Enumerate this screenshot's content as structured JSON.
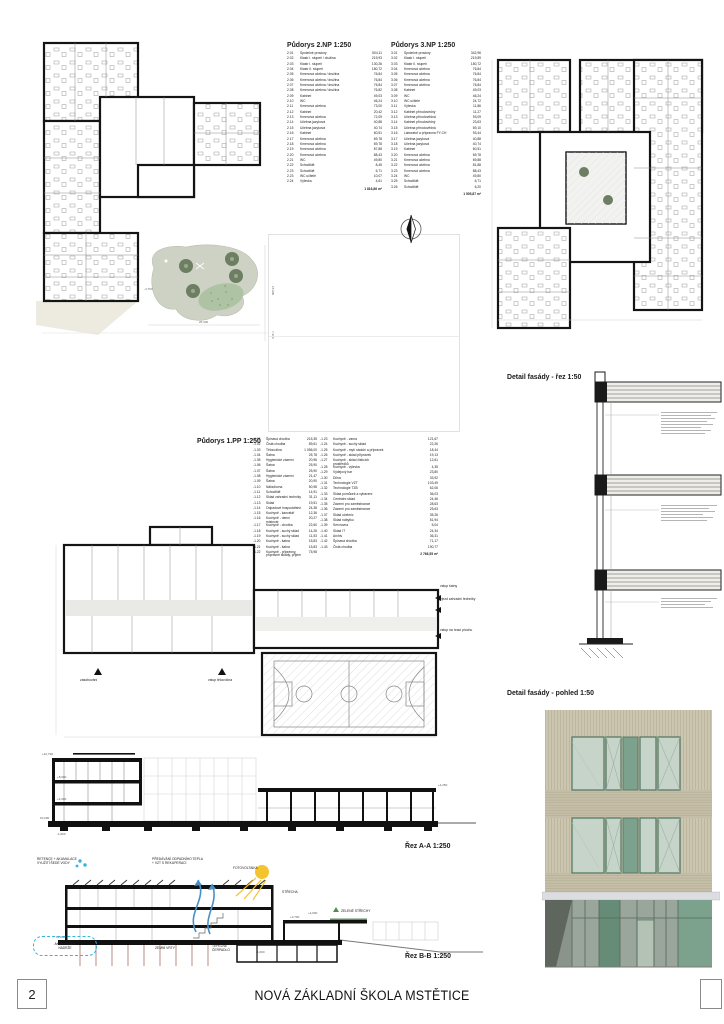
{
  "sheet": {
    "number": "2",
    "title": "NOVÁ ZÁKLADNÍ ŠKOLA MSTĚTICE"
  },
  "legend_np2": {
    "title": "Půdorys 2.NP  1:250",
    "rows": [
      [
        "2.01",
        "Společné prostory",
        "504,11"
      ],
      [
        "2.02",
        "Klastr I. stupeň / družina",
        "219,93"
      ],
      [
        "2.03",
        "Klastr I. stupeň",
        "130,26"
      ],
      [
        "2.04",
        "Klastr II. stupeň",
        "180,72"
      ],
      [
        "2.05",
        "Kmenová učebna / družina",
        "76,84"
      ],
      [
        "2.06",
        "Kmenová učebna / družina",
        "76,84"
      ],
      [
        "2.07",
        "Kmenová učebna / družina",
        "76,84"
      ],
      [
        "2.08",
        "Kmenová učebna / družina",
        "76,82"
      ],
      [
        "2.09",
        "Kabinet",
        "49,03"
      ],
      [
        "2.10",
        "WC",
        "46,24"
      ],
      [
        "2.11",
        "Kmenová učebna",
        "73,00"
      ],
      [
        "2.12",
        "Kabinet",
        "20,42"
      ],
      [
        "2.13",
        "Kmenová učebna",
        "72,09"
      ],
      [
        "2.14",
        "Učebna jazyková",
        "40,88"
      ],
      [
        "2.15",
        "Učebna jazyková",
        "40,74"
      ],
      [
        "2.16",
        "Kabinet",
        "60,51"
      ],
      [
        "2.17",
        "Kmenová učebna",
        "69,78"
      ],
      [
        "2.18",
        "Kmenová učebna",
        "69,78"
      ],
      [
        "2.19",
        "Kmenová učebna",
        "87,88"
      ],
      [
        "2.20",
        "Kmenová učebna",
        "88,43"
      ],
      [
        "2.21",
        "WC",
        "49,80"
      ],
      [
        "2.22",
        "Schodiště",
        "8,45"
      ],
      [
        "2.23",
        "Schodiště",
        "6,71"
      ],
      [
        "2.23",
        "WC učitelé",
        "10,07"
      ],
      [
        "2.24",
        "Výlevka",
        "4,61"
      ]
    ],
    "total": "1 816,86 m²"
  },
  "legend_np3": {
    "title": "Půdorys 3.NP  1:250",
    "rows": [
      [
        "3.01",
        "Společné prostory",
        "342,96"
      ],
      [
        "3.02",
        "Klastr I. stupeň",
        "219,89"
      ],
      [
        "3.03",
        "Klastr II. stupeň",
        "180,72"
      ],
      [
        "3.04",
        "Kmenová učebna",
        "76,84"
      ],
      [
        "3.05",
        "Kmenová učebna",
        "76,84"
      ],
      [
        "3.06",
        "Kmenová učebna",
        "76,84"
      ],
      [
        "3.07",
        "Kmenová učebna",
        "76,84"
      ],
      [
        "3.08",
        "Kabinet",
        "49,03"
      ],
      [
        "3.09",
        "WC",
        "46,24"
      ],
      [
        "3.10",
        "WC učitelé",
        "24,72"
      ],
      [
        "3.11",
        "Výlevka",
        "11,86"
      ],
      [
        "3.12",
        "Kabinet přírodovědný",
        "11,27"
      ],
      [
        "3.13",
        "Učebna přírodovědná",
        "93,09"
      ],
      [
        "3.14",
        "Kabinet přírodovědný",
        "23,63"
      ],
      [
        "3.15",
        "Učebna přírodovědná",
        "69,10"
      ],
      [
        "3.16",
        "Laboratoř a přípravna FY-CH",
        "93,44"
      ],
      [
        "3.17",
        "Učebna jazyková",
        "40,88"
      ],
      [
        "3.18",
        "Učebna jazyková",
        "40,74"
      ],
      [
        "3.19",
        "Kabinet",
        "60,51"
      ],
      [
        "3.20",
        "Kmenová učebna",
        "69,78"
      ],
      [
        "3.21",
        "Kmenová učebna",
        "69,88"
      ],
      [
        "3.22",
        "Kmenová učebna",
        "81,88"
      ],
      [
        "3.23",
        "Kmenová učebna",
        "88,43"
      ],
      [
        "3.24",
        "WC",
        "49,80"
      ],
      [
        "3.25",
        "Schodiště",
        "6,71"
      ],
      [
        "3.26",
        "Schodiště",
        "6,20"
      ]
    ],
    "total": "1 505,87 m²"
  },
  "legend_pp1": {
    "title": "Půdorys 1.PP  1:250",
    "rows_left": [
      [
        "-1.01",
        "Špinavá chodba",
        "215,35"
      ],
      [
        "-1.02",
        "Čistá chodba",
        "89,61"
      ],
      [
        "-1.03",
        "Tělocvična",
        "1 056,00"
      ],
      [
        "-1.04",
        "Šatna",
        "25,78"
      ],
      [
        "-1.05",
        "Hygienické zázemí",
        "20,96"
      ],
      [
        "-1.06",
        "Šatna",
        "25,90"
      ],
      [
        "-1.07",
        "Šatna",
        "25,90"
      ],
      [
        "-1.08",
        "Hygienické zázemí",
        "21,47"
      ],
      [
        "-1.09",
        "Šatna",
        "20,90"
      ],
      [
        "-1.10",
        "Nářaďovna",
        "50,98"
      ],
      [
        "-1.11",
        "Schodiště",
        "14,91"
      ],
      [
        "-1.12",
        "Sklad zahradní techniky",
        "31,11"
      ],
      [
        "-1.13",
        "Sklad",
        "19,51"
      ],
      [
        "-1.14",
        "Odpadové hospodářství",
        "24,38"
      ],
      [
        "-1.15",
        "Kuchyně - kancelář",
        "12,36"
      ],
      [
        "-1.16",
        "Kuchyně - denní místnost",
        "20,27"
      ],
      [
        "-1.17",
        "Kuchyně - chodba",
        "22,60"
      ],
      [
        "-1.18",
        "Kuchyně - suchý sklad",
        "14,26"
      ],
      [
        "-1.19",
        "Kuchyně - suchý sklad",
        "11,53"
      ],
      [
        "-1.20",
        "Kuchyně - šatna",
        "15,83"
      ],
      [
        "-1.21",
        "Kuchyně - šatna",
        "15,83"
      ],
      [
        "-1.22",
        "Kuchyně - přípravny, přípravné sklady, příjem",
        "75,98"
      ]
    ],
    "rows_right": [
      [
        "-1.23",
        "Kuchyně - varna",
        "121,67"
      ],
      [
        "-1.24",
        "Kuchyně - suchý sklad",
        "22,26"
      ],
      [
        "-1.25",
        "Kuchyně - mytí nádobí a přípravek",
        "18,44"
      ],
      [
        "-1.26",
        "Kuchyně - sklad přípravek",
        "19,13"
      ],
      [
        "-1.27",
        "Kuchyně - sklad čisticích prostředků",
        "12,61"
      ],
      [
        "-1.28",
        "Kuchyně - výlevka",
        "4,35"
      ],
      [
        "-1.29",
        "Výdejový bar",
        "23,80"
      ],
      [
        "-1.30",
        "Dílna",
        "33,92"
      ],
      [
        "-1.31",
        "Technologie VZT",
        "103,49"
      ],
      [
        "-1.32",
        "Technologie TZB",
        "62,06"
      ],
      [
        "-1.33",
        "Sklad pomůcek a vybavení",
        "36,03"
      ],
      [
        "-1.34",
        "Centrální sklad",
        "24,46"
      ],
      [
        "-1.35",
        "Zázemí pro zaměstnance",
        "28,63"
      ],
      [
        "-1.36",
        "Zázemí pro zaměstnance",
        "25,63"
      ],
      [
        "-1.37",
        "Sklad učebnic",
        "35,26"
      ],
      [
        "-1.38",
        "Sklad nábytku",
        "51,94"
      ],
      [
        "-1.39",
        "Servrovna",
        "5,04"
      ],
      [
        "-1.40",
        "Sklad IT",
        "24,34"
      ],
      [
        "-1.41",
        "Archiv",
        "36,31"
      ],
      [
        "-1.42",
        "Špinavá chodba",
        "71,17"
      ],
      [
        "-1.43",
        "Čistá chodba",
        "190,77"
      ]
    ],
    "total": "2 766,55 m²"
  },
  "details": {
    "facade_section_title": "Detail fasády - řez 1:50",
    "facade_elevation_title": "Detail fasády - pohled 1:50"
  },
  "sections": {
    "a_label": "Řez A-A 1:250",
    "b_label": "Řez B-B 1:250"
  },
  "plan_pp1_labels": {
    "vstup_satny": "vstup šatny",
    "vjezd": "vjezd zahradní techniky",
    "vstup_hraci": "vstup na hrací plochu",
    "zasobovani": "zásobování",
    "vstup_telocvicna": "vstup tělocvična"
  },
  "eco": {
    "retence": "RETENCE + AKUMULACE\nVYUŽITÍ ŠEDÉ VODY",
    "teplo": "PŘEDÁVÁNÍ ODPADNÍHO TEPLA\n+ VZT S REKUPERACÍ",
    "fotovoltaika": "FOTOVOLTAIKA",
    "strecha": "STŘECHA",
    "zelene": "ZELENÉ STŘECHY",
    "nadrze": "AKUMULAČNÍ\nNÁDRŽE",
    "vrty": "ZEMNÍ VRTY",
    "cerpadlo": "TEPELNÉ\nČERPADLO"
  },
  "plan2_dims": [
    "-4.750",
    "26.300",
    "18.900",
    "7.300"
  ],
  "levels_a": [
    "+12,790",
    "+8,000",
    "+4,000",
    "±0,000",
    "-1,000",
    "+4,250"
  ],
  "levels_b": [
    "±0,000",
    "+4,000",
    "+3,700",
    "-1,000"
  ],
  "colors": {
    "water_accent": "#35b6d9",
    "sun": "#f4c42e",
    "green_roof": "#4f8f4f",
    "tree": "#6e7e62",
    "courtyard": "#cdd2c5",
    "facade_cladding": "#ccc6b1",
    "facade_stripe": "#b8b199",
    "window_glass": "#c6d4ca",
    "window_frame": "#587a66",
    "panel_green": "#7ca28d",
    "storefront_green": "#668b76",
    "borehole": "#a76f5f"
  }
}
